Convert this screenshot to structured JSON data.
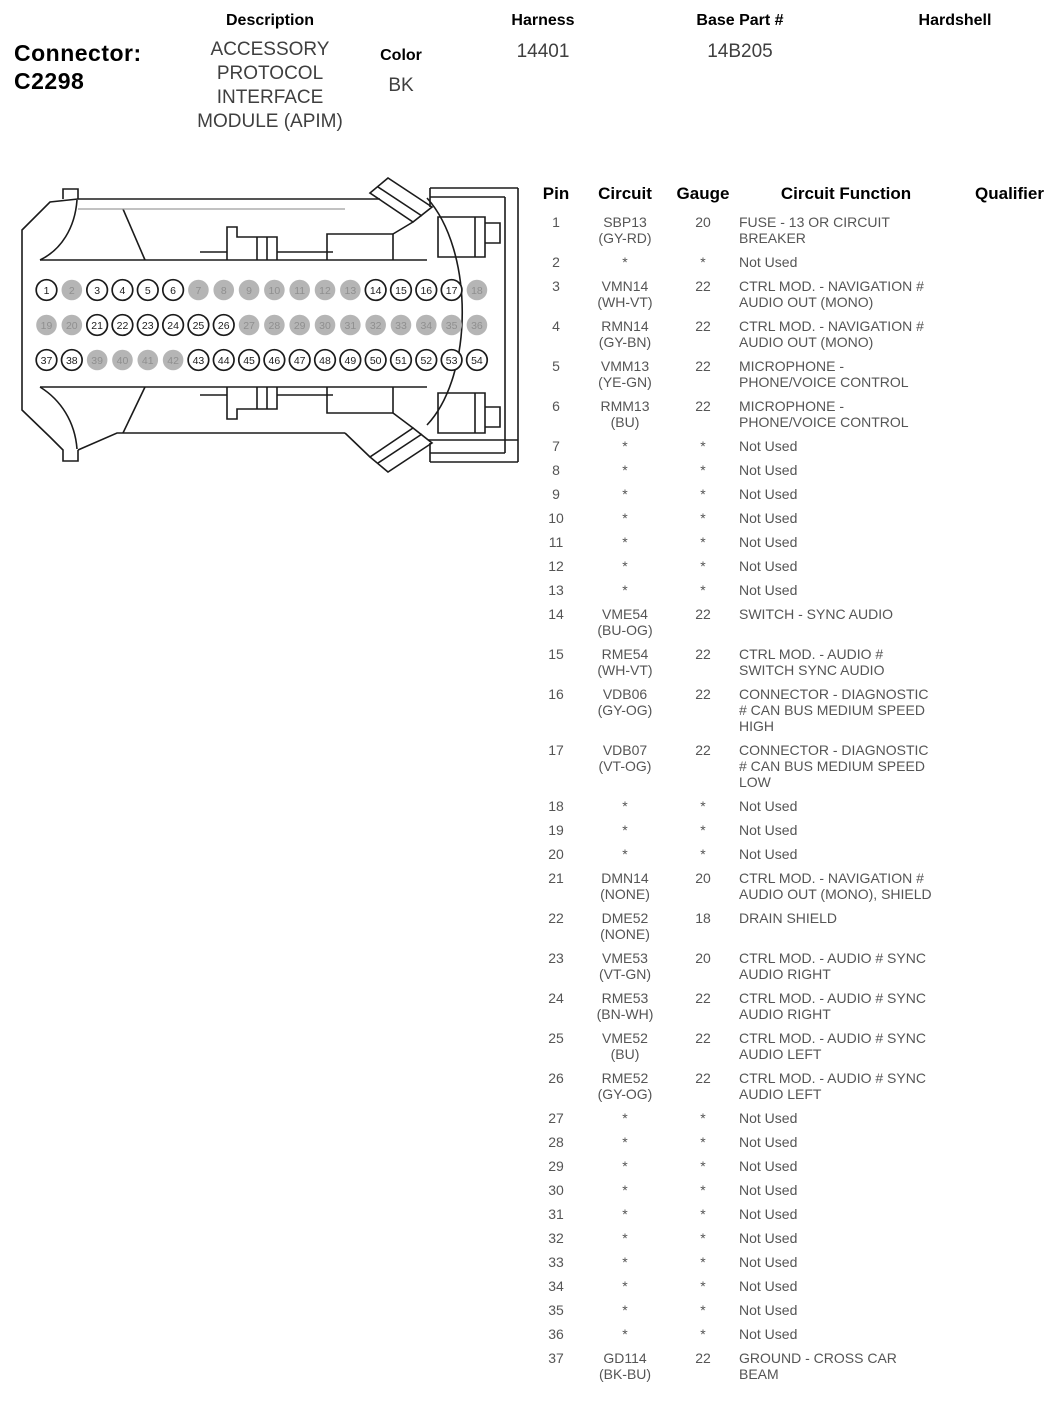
{
  "header": {
    "connector_label": "Connector:",
    "connector_id": "C2298",
    "columns": {
      "description": "Description",
      "color": "Color",
      "harness": "Harness",
      "base_part": "Base Part #",
      "hardshell": "Hardshell"
    },
    "values": {
      "description": "ACCESSORY\nPROTOCOL\nINTERFACE\nMODULE (APIM)",
      "color": "BK",
      "harness": "14401",
      "base_part": "14B205",
      "hardshell": ""
    }
  },
  "connector_diagram": {
    "rows": 3,
    "cols": 18,
    "used_fill": "#ffffff",
    "not_used_fill": "#b5b5b5",
    "outline_color": "#1b1b1b",
    "used_number_color": "#1b1b1b",
    "not_used_number_color": "#8f8f8f",
    "pins": [
      {
        "n": 1,
        "used": true
      },
      {
        "n": 2,
        "used": false
      },
      {
        "n": 3,
        "used": true
      },
      {
        "n": 4,
        "used": true
      },
      {
        "n": 5,
        "used": true
      },
      {
        "n": 6,
        "used": true
      },
      {
        "n": 7,
        "used": false
      },
      {
        "n": 8,
        "used": false
      },
      {
        "n": 9,
        "used": false
      },
      {
        "n": 10,
        "used": false
      },
      {
        "n": 11,
        "used": false
      },
      {
        "n": 12,
        "used": false
      },
      {
        "n": 13,
        "used": false
      },
      {
        "n": 14,
        "used": true
      },
      {
        "n": 15,
        "used": true
      },
      {
        "n": 16,
        "used": true
      },
      {
        "n": 17,
        "used": true
      },
      {
        "n": 18,
        "used": false
      },
      {
        "n": 19,
        "used": false
      },
      {
        "n": 20,
        "used": false
      },
      {
        "n": 21,
        "used": true
      },
      {
        "n": 22,
        "used": true
      },
      {
        "n": 23,
        "used": true
      },
      {
        "n": 24,
        "used": true
      },
      {
        "n": 25,
        "used": true
      },
      {
        "n": 26,
        "used": true
      },
      {
        "n": 27,
        "used": false
      },
      {
        "n": 28,
        "used": false
      },
      {
        "n": 29,
        "used": false
      },
      {
        "n": 30,
        "used": false
      },
      {
        "n": 31,
        "used": false
      },
      {
        "n": 32,
        "used": false
      },
      {
        "n": 33,
        "used": false
      },
      {
        "n": 34,
        "used": false
      },
      {
        "n": 35,
        "used": false
      },
      {
        "n": 36,
        "used": false
      },
      {
        "n": 37,
        "used": true
      },
      {
        "n": 38,
        "used": true
      },
      {
        "n": 39,
        "used": false
      },
      {
        "n": 40,
        "used": false
      },
      {
        "n": 41,
        "used": false
      },
      {
        "n": 42,
        "used": false
      },
      {
        "n": 43,
        "used": true
      },
      {
        "n": 44,
        "used": true
      },
      {
        "n": 45,
        "used": true
      },
      {
        "n": 46,
        "used": true
      },
      {
        "n": 47,
        "used": true
      },
      {
        "n": 48,
        "used": true
      },
      {
        "n": 49,
        "used": true
      },
      {
        "n": 50,
        "used": true
      },
      {
        "n": 51,
        "used": true
      },
      {
        "n": 52,
        "used": true
      },
      {
        "n": 53,
        "used": true
      },
      {
        "n": 54,
        "used": true
      }
    ]
  },
  "table": {
    "columns": [
      "Pin",
      "Circuit",
      "Gauge",
      "Circuit Function",
      "Qualifier"
    ],
    "rows": [
      {
        "pin": "1",
        "circuit": "SBP13",
        "color": "(GY-RD)",
        "gauge": "20",
        "function": "FUSE - 13 OR CIRCUIT\nBREAKER",
        "qualifier": ""
      },
      {
        "pin": "2",
        "circuit": "*",
        "color": "",
        "gauge": "*",
        "function": "Not Used",
        "qualifier": ""
      },
      {
        "pin": "3",
        "circuit": "VMN14",
        "color": "(WH-VT)",
        "gauge": "22",
        "function": "CTRL MOD. - NAVIGATION #\nAUDIO OUT (MONO)",
        "qualifier": ""
      },
      {
        "pin": "4",
        "circuit": "RMN14",
        "color": "(GY-BN)",
        "gauge": "22",
        "function": "CTRL MOD. - NAVIGATION #\nAUDIO OUT (MONO)",
        "qualifier": ""
      },
      {
        "pin": "5",
        "circuit": "VMM13",
        "color": "(YE-GN)",
        "gauge": "22",
        "function": "MICROPHONE -\nPHONE/VOICE CONTROL",
        "qualifier": ""
      },
      {
        "pin": "6",
        "circuit": "RMM13",
        "color": "(BU)",
        "gauge": "22",
        "function": "MICROPHONE -\nPHONE/VOICE CONTROL",
        "qualifier": ""
      },
      {
        "pin": "7",
        "circuit": "*",
        "color": "",
        "gauge": "*",
        "function": "Not Used",
        "qualifier": ""
      },
      {
        "pin": "8",
        "circuit": "*",
        "color": "",
        "gauge": "*",
        "function": "Not Used",
        "qualifier": ""
      },
      {
        "pin": "9",
        "circuit": "*",
        "color": "",
        "gauge": "*",
        "function": "Not Used",
        "qualifier": ""
      },
      {
        "pin": "10",
        "circuit": "*",
        "color": "",
        "gauge": "*",
        "function": "Not Used",
        "qualifier": ""
      },
      {
        "pin": "11",
        "circuit": "*",
        "color": "",
        "gauge": "*",
        "function": "Not Used",
        "qualifier": ""
      },
      {
        "pin": "12",
        "circuit": "*",
        "color": "",
        "gauge": "*",
        "function": "Not Used",
        "qualifier": ""
      },
      {
        "pin": "13",
        "circuit": "*",
        "color": "",
        "gauge": "*",
        "function": "Not Used",
        "qualifier": ""
      },
      {
        "pin": "14",
        "circuit": "VME54",
        "color": "(BU-OG)",
        "gauge": "22",
        "function": "SWITCH - SYNC AUDIO",
        "qualifier": ""
      },
      {
        "pin": "15",
        "circuit": "RME54",
        "color": "(WH-VT)",
        "gauge": "22",
        "function": "CTRL MOD. - AUDIO #\nSWITCH SYNC AUDIO",
        "qualifier": ""
      },
      {
        "pin": "16",
        "circuit": "VDB06",
        "color": "(GY-OG)",
        "gauge": "22",
        "function": "CONNECTOR - DIAGNOSTIC\n# CAN BUS MEDIUM SPEED\nHIGH",
        "qualifier": ""
      },
      {
        "pin": "17",
        "circuit": "VDB07",
        "color": "(VT-OG)",
        "gauge": "22",
        "function": "CONNECTOR - DIAGNOSTIC\n# CAN BUS MEDIUM SPEED\nLOW",
        "qualifier": ""
      },
      {
        "pin": "18",
        "circuit": "*",
        "color": "",
        "gauge": "*",
        "function": "Not Used",
        "qualifier": ""
      },
      {
        "pin": "19",
        "circuit": "*",
        "color": "",
        "gauge": "*",
        "function": "Not Used",
        "qualifier": ""
      },
      {
        "pin": "20",
        "circuit": "*",
        "color": "",
        "gauge": "*",
        "function": "Not Used",
        "qualifier": ""
      },
      {
        "pin": "21",
        "circuit": "DMN14",
        "color": "(NONE)",
        "gauge": "20",
        "function": "CTRL MOD. - NAVIGATION #\nAUDIO OUT (MONO), SHIELD",
        "qualifier": ""
      },
      {
        "pin": "22",
        "circuit": "DME52",
        "color": "(NONE)",
        "gauge": "18",
        "function": "DRAIN SHIELD",
        "qualifier": ""
      },
      {
        "pin": "23",
        "circuit": "VME53",
        "color": "(VT-GN)",
        "gauge": "20",
        "function": "CTRL MOD. - AUDIO # SYNC\nAUDIO RIGHT",
        "qualifier": ""
      },
      {
        "pin": "24",
        "circuit": "RME53",
        "color": "(BN-WH)",
        "gauge": "22",
        "function": "CTRL MOD. - AUDIO # SYNC\nAUDIO RIGHT",
        "qualifier": ""
      },
      {
        "pin": "25",
        "circuit": "VME52",
        "color": "(BU)",
        "gauge": "22",
        "function": "CTRL MOD. - AUDIO # SYNC\nAUDIO LEFT",
        "qualifier": ""
      },
      {
        "pin": "26",
        "circuit": "RME52",
        "color": "(GY-OG)",
        "gauge": "22",
        "function": "CTRL MOD. - AUDIO # SYNC\nAUDIO LEFT",
        "qualifier": ""
      },
      {
        "pin": "27",
        "circuit": "*",
        "color": "",
        "gauge": "*",
        "function": "Not Used",
        "qualifier": ""
      },
      {
        "pin": "28",
        "circuit": "*",
        "color": "",
        "gauge": "*",
        "function": "Not Used",
        "qualifier": ""
      },
      {
        "pin": "29",
        "circuit": "*",
        "color": "",
        "gauge": "*",
        "function": "Not Used",
        "qualifier": ""
      },
      {
        "pin": "30",
        "circuit": "*",
        "color": "",
        "gauge": "*",
        "function": "Not Used",
        "qualifier": ""
      },
      {
        "pin": "31",
        "circuit": "*",
        "color": "",
        "gauge": "*",
        "function": "Not Used",
        "qualifier": ""
      },
      {
        "pin": "32",
        "circuit": "*",
        "color": "",
        "gauge": "*",
        "function": "Not Used",
        "qualifier": ""
      },
      {
        "pin": "33",
        "circuit": "*",
        "color": "",
        "gauge": "*",
        "function": "Not Used",
        "qualifier": ""
      },
      {
        "pin": "34",
        "circuit": "*",
        "color": "",
        "gauge": "*",
        "function": "Not Used",
        "qualifier": ""
      },
      {
        "pin": "35",
        "circuit": "*",
        "color": "",
        "gauge": "*",
        "function": "Not Used",
        "qualifier": ""
      },
      {
        "pin": "36",
        "circuit": "*",
        "color": "",
        "gauge": "*",
        "function": "Not Used",
        "qualifier": ""
      },
      {
        "pin": "37",
        "circuit": "GD114",
        "color": "(BK-BU)",
        "gauge": "22",
        "function": "GROUND - CROSS CAR\nBEAM",
        "qualifier": ""
      }
    ]
  }
}
